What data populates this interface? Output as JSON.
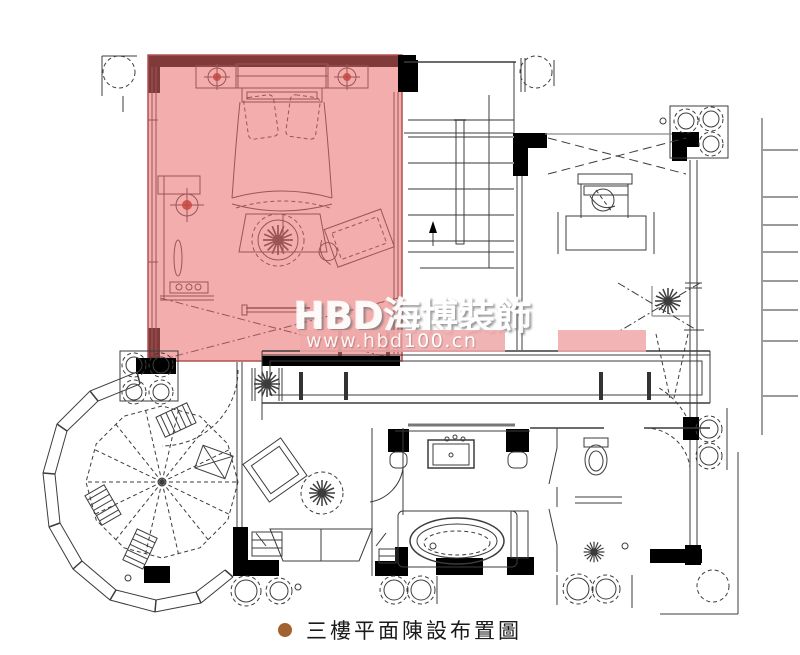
{
  "watermark": {
    "brand": "HBD海博裝飾",
    "url": "www.hbd100.cn"
  },
  "caption": {
    "title": "三樓平面陳設布置圖"
  },
  "colors": {
    "highlight": "#e96a6a",
    "highlight_border": "#b25050",
    "wall": "#000000",
    "line": "#3c3c3c",
    "step_line": "#9a9a9a",
    "watermark_band": "#f0aaaa",
    "watermark_text": "#ffffff",
    "caption_bullet": "#a2622f",
    "caption_text": "#1a1a1a",
    "lamp_accent": "#cc3322"
  }
}
